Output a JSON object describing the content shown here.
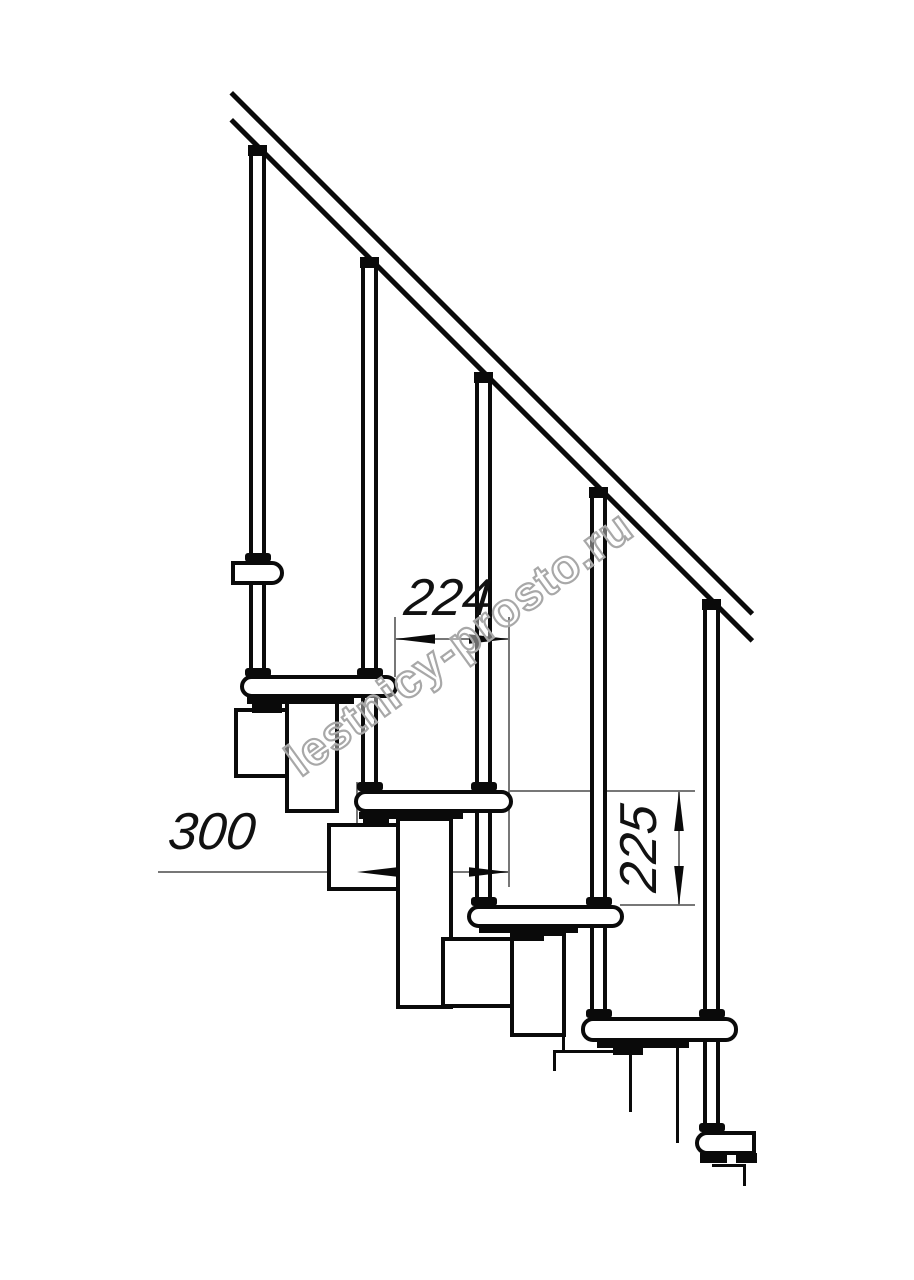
{
  "drawing": {
    "title": "Modular staircase side-view fragment (technical drawing)",
    "watermark": "lestnicy-prosto.ru",
    "dims": {
      "step_run": "224",
      "tread_depth": "300",
      "riser_height": "225"
    },
    "colors": {
      "ink": "#0a0a0a",
      "dimension_line": "#777777",
      "watermark_outline": "#a8a8a8",
      "background": "#ffffff"
    }
  }
}
